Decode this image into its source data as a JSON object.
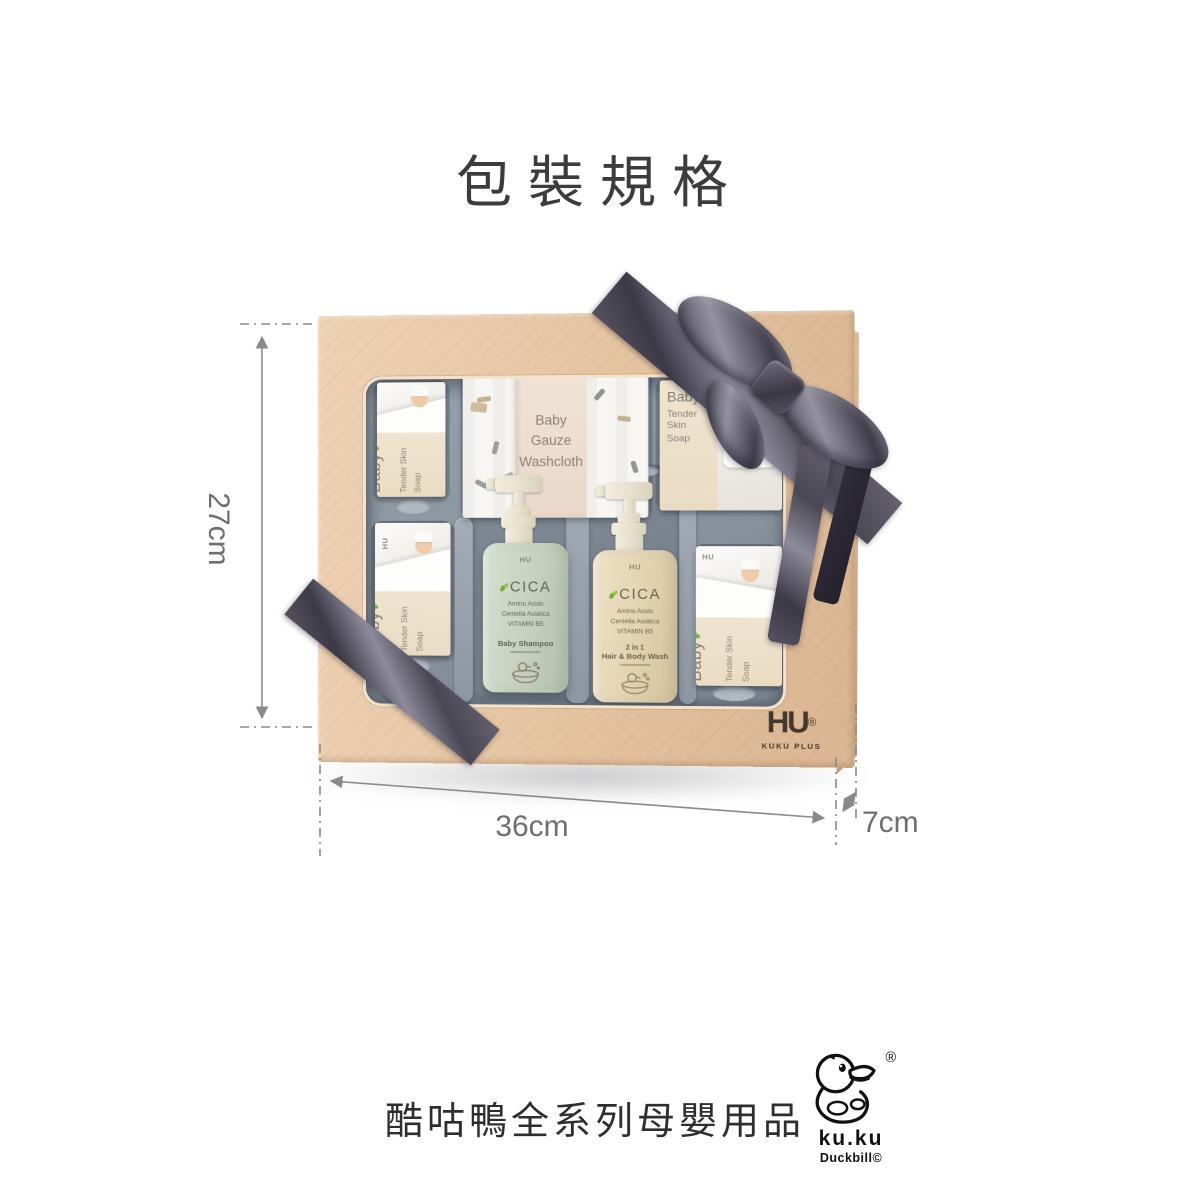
{
  "title": "包裝規格",
  "dimensions": {
    "height": "27cm",
    "width": "36cm",
    "depth": "7cm"
  },
  "box": {
    "logo": "HU",
    "logo_sub": "KUKU PLUS",
    "logo_reg": "®",
    "soap_card": {
      "brand": "Baby",
      "line1": "Tender Skin",
      "line2": "Soap"
    },
    "gauze": {
      "line1": "Baby",
      "line2": "Gauze",
      "line3": "Washcloth"
    },
    "shampoo": {
      "name": "CICA",
      "ing1": "Amino Acids",
      "ing2": "Centella Asiatica",
      "ing3": "VITAMIN B5",
      "type": "Baby Shampoo"
    },
    "bodywash": {
      "name": "CICA",
      "ing1": "Amino Acids",
      "ing2": "Centella Asiatica",
      "ing3": "VITAMIN B5",
      "type1": "2 in 1",
      "type2": "Hair & Body Wash"
    }
  },
  "footer": {
    "text": "酷咕鴨全系列母嬰用品",
    "brand": "ku.ku",
    "brand_sub": "Duckbill©",
    "registered": "®"
  },
  "colors": {
    "box_tan": "#e6c6a5",
    "tray_gray": "#8e98a2",
    "ribbon": "#4e4b5c",
    "bottle_green": "#ccd7c6",
    "bottle_beige": "#e8d8b8",
    "dimension_gray": "#8c8c8c"
  }
}
